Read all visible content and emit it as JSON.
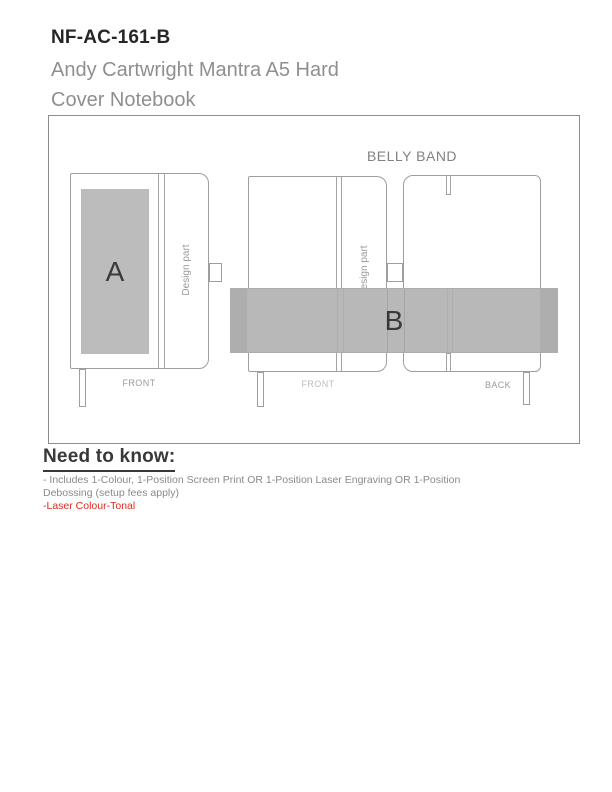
{
  "header": {
    "product_code": "NF-AC-161-B",
    "product_name_line1": "Andy Cartwright Mantra A5 Hard",
    "product_name_line2": "Cover Notebook"
  },
  "diagram": {
    "belly_band_label": "BELLY BAND",
    "front_notebook": {
      "print_area_label": "A",
      "design_part_label": "Design part",
      "caption": "FRONT"
    },
    "middle_notebook": {
      "design_part_label": "Design part",
      "caption": "FRONT"
    },
    "back_notebook": {
      "caption": "BACK"
    },
    "belly_band": {
      "label": "B"
    }
  },
  "need_to_know": {
    "heading": "Need to know:",
    "note_line1": "- Includes 1-Colour, 1-Position Screen Print OR 1-Position Laser Engraving OR 1-Position",
    "note_line2": "Debossing (setup fees apply)",
    "laser_note": "-Laser Colour-Tonal"
  },
  "colors": {
    "laser_note_red": "#e02a20",
    "belly_band_gray": "#b8b8b8",
    "belly_band_end_gray": "#aeaeae",
    "print_area_gray": "#bcbcbc"
  }
}
